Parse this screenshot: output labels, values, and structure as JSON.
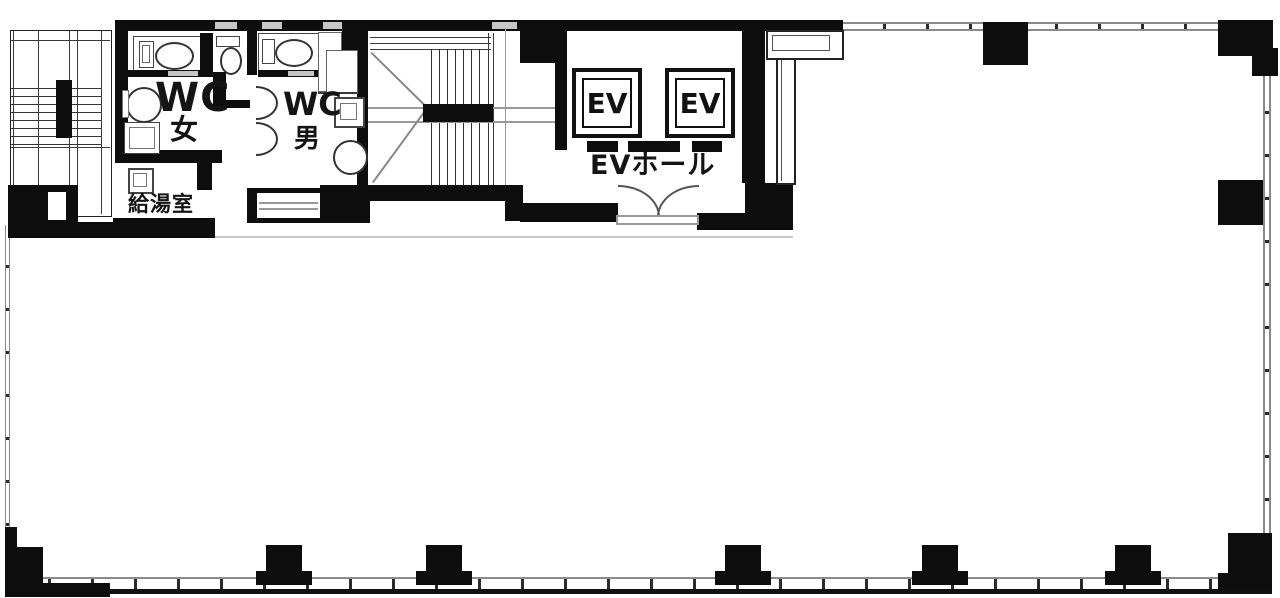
{
  "plan": {
    "type": "office-floor-plan",
    "rooms": {
      "wc_women": {
        "label": "WC",
        "gender": "女"
      },
      "wc_men": {
        "label": "WC",
        "gender": "男"
      },
      "kitchenette": {
        "label": "給湯室"
      },
      "ev_hall": {
        "label": "EVホール"
      },
      "elevators": [
        {
          "label": "EV"
        },
        {
          "label": "EV"
        }
      ]
    },
    "colors": {
      "wall": "#0d0d0d",
      "window_line": "#8a8a8a",
      "window_slot": "#c6c6c6",
      "floor": "#ffffff"
    }
  }
}
